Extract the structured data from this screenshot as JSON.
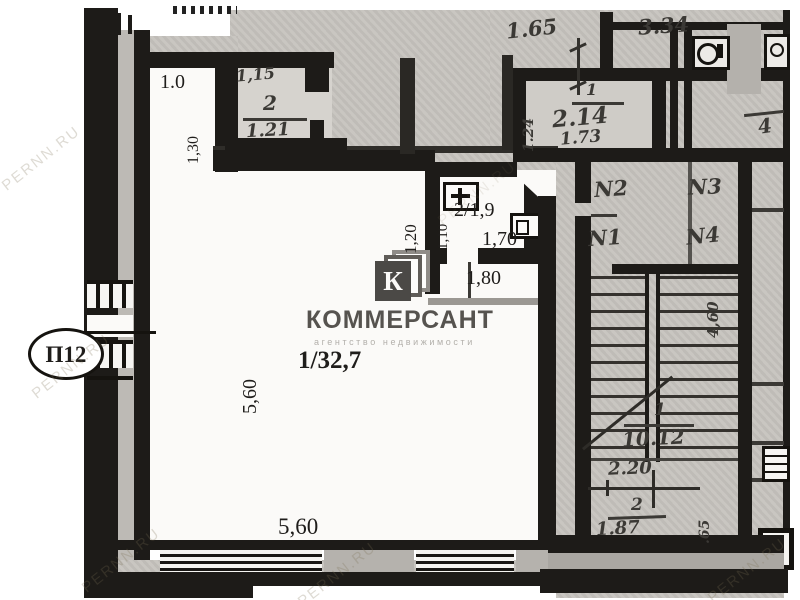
{
  "colors": {
    "wall": "#1d1b18",
    "scan_gray": "#c6c3be",
    "paper": "#fbfaf8",
    "pencil": "#3b3935",
    "logo_square": "#4b4946",
    "logo_text": "#56534f",
    "logo_subtitle": "#b3b0ab"
  },
  "unit": {
    "label": "П12"
  },
  "logo": {
    "letter": "К",
    "brand": "КОММЕРСАНТ",
    "subtitle": "агентство недвижимости"
  },
  "watermark": {
    "text": "PERNN.RU"
  },
  "main_room": {
    "label": "1/32,7",
    "width": "5,60",
    "depth": "5,60",
    "niche_width": "1.0",
    "niche_depth": "1,30"
  },
  "wc": {
    "label": "2/1,9",
    "width": "1,70",
    "door_dim": "1,80",
    "depth": "1,10",
    "offset": "1,20"
  },
  "room2": {
    "width": "1,15",
    "number": "2",
    "area": "1.21"
  },
  "upper": {
    "dim_a": "1.65",
    "dim_b": "3.34"
  },
  "room214": {
    "number": "1",
    "area": "2.14",
    "width": "1.73",
    "depth": "1.24"
  },
  "room4": {
    "number": "4"
  },
  "stair": {
    "doors": [
      "N2",
      "N3",
      "N1",
      "N4"
    ],
    "flight_width": "4,60",
    "landing_number": "1",
    "landing_area": "10.12",
    "dim_a": "2.20",
    "room_number": "2",
    "room_area": "1.87",
    "dim_b": ".65"
  }
}
